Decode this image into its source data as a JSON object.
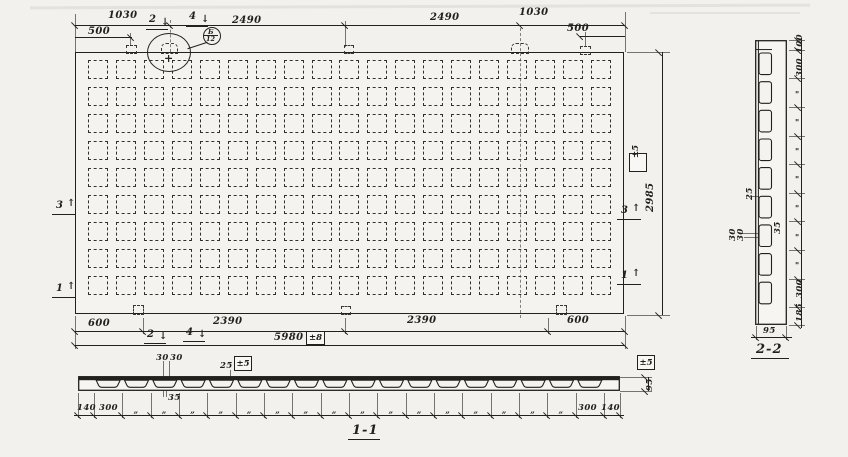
{
  "plan": {
    "grid": {
      "rows": 9,
      "cols": 19
    },
    "dims_top": {
      "left_1030": "1030",
      "left_500": "500",
      "left_2490": "2490",
      "right_2490": "2490",
      "right_1030": "1030",
      "right_500": "500"
    },
    "dims_bottom": {
      "left_600": "600",
      "left_2390": "2390",
      "right_2390": "2390",
      "right_600": "600",
      "total": "5980",
      "total_tol": "±8"
    },
    "dims_side": {
      "height": "2985",
      "height_tol": "±5"
    },
    "cut_labels": {
      "top_2": "2",
      "top_4": "4",
      "bottom_2": "2",
      "bottom_4": "4",
      "left_3": "3",
      "left_1": "1",
      "right_3": "3",
      "right_1": "1"
    },
    "callout": {
      "top": "Б",
      "bottom": "12"
    },
    "arrow_down": "↓",
    "arrow_up": "↑"
  },
  "section_1_1": {
    "label": "1-1",
    "void_count": 18,
    "dims": {
      "gap_left": "30",
      "gap_right": "30",
      "flange": "25",
      "flange_tol": "±5",
      "rib": "35",
      "end_left": "140",
      "pitch_left": "300",
      "ditto": "„",
      "pitch_right": "300",
      "end_right": "140",
      "height": "95",
      "height_tol": "±5"
    }
  },
  "section_2_2": {
    "label": "2-2",
    "void_count": 9,
    "dims": {
      "end_top": "100",
      "pitch_top": "300",
      "ditto": "\"",
      "pitch_bottom": "300",
      "end_bottom": "185",
      "width": "95",
      "rib": "25",
      "gap_a": "30",
      "gap_b": "30",
      "web": "35"
    }
  }
}
